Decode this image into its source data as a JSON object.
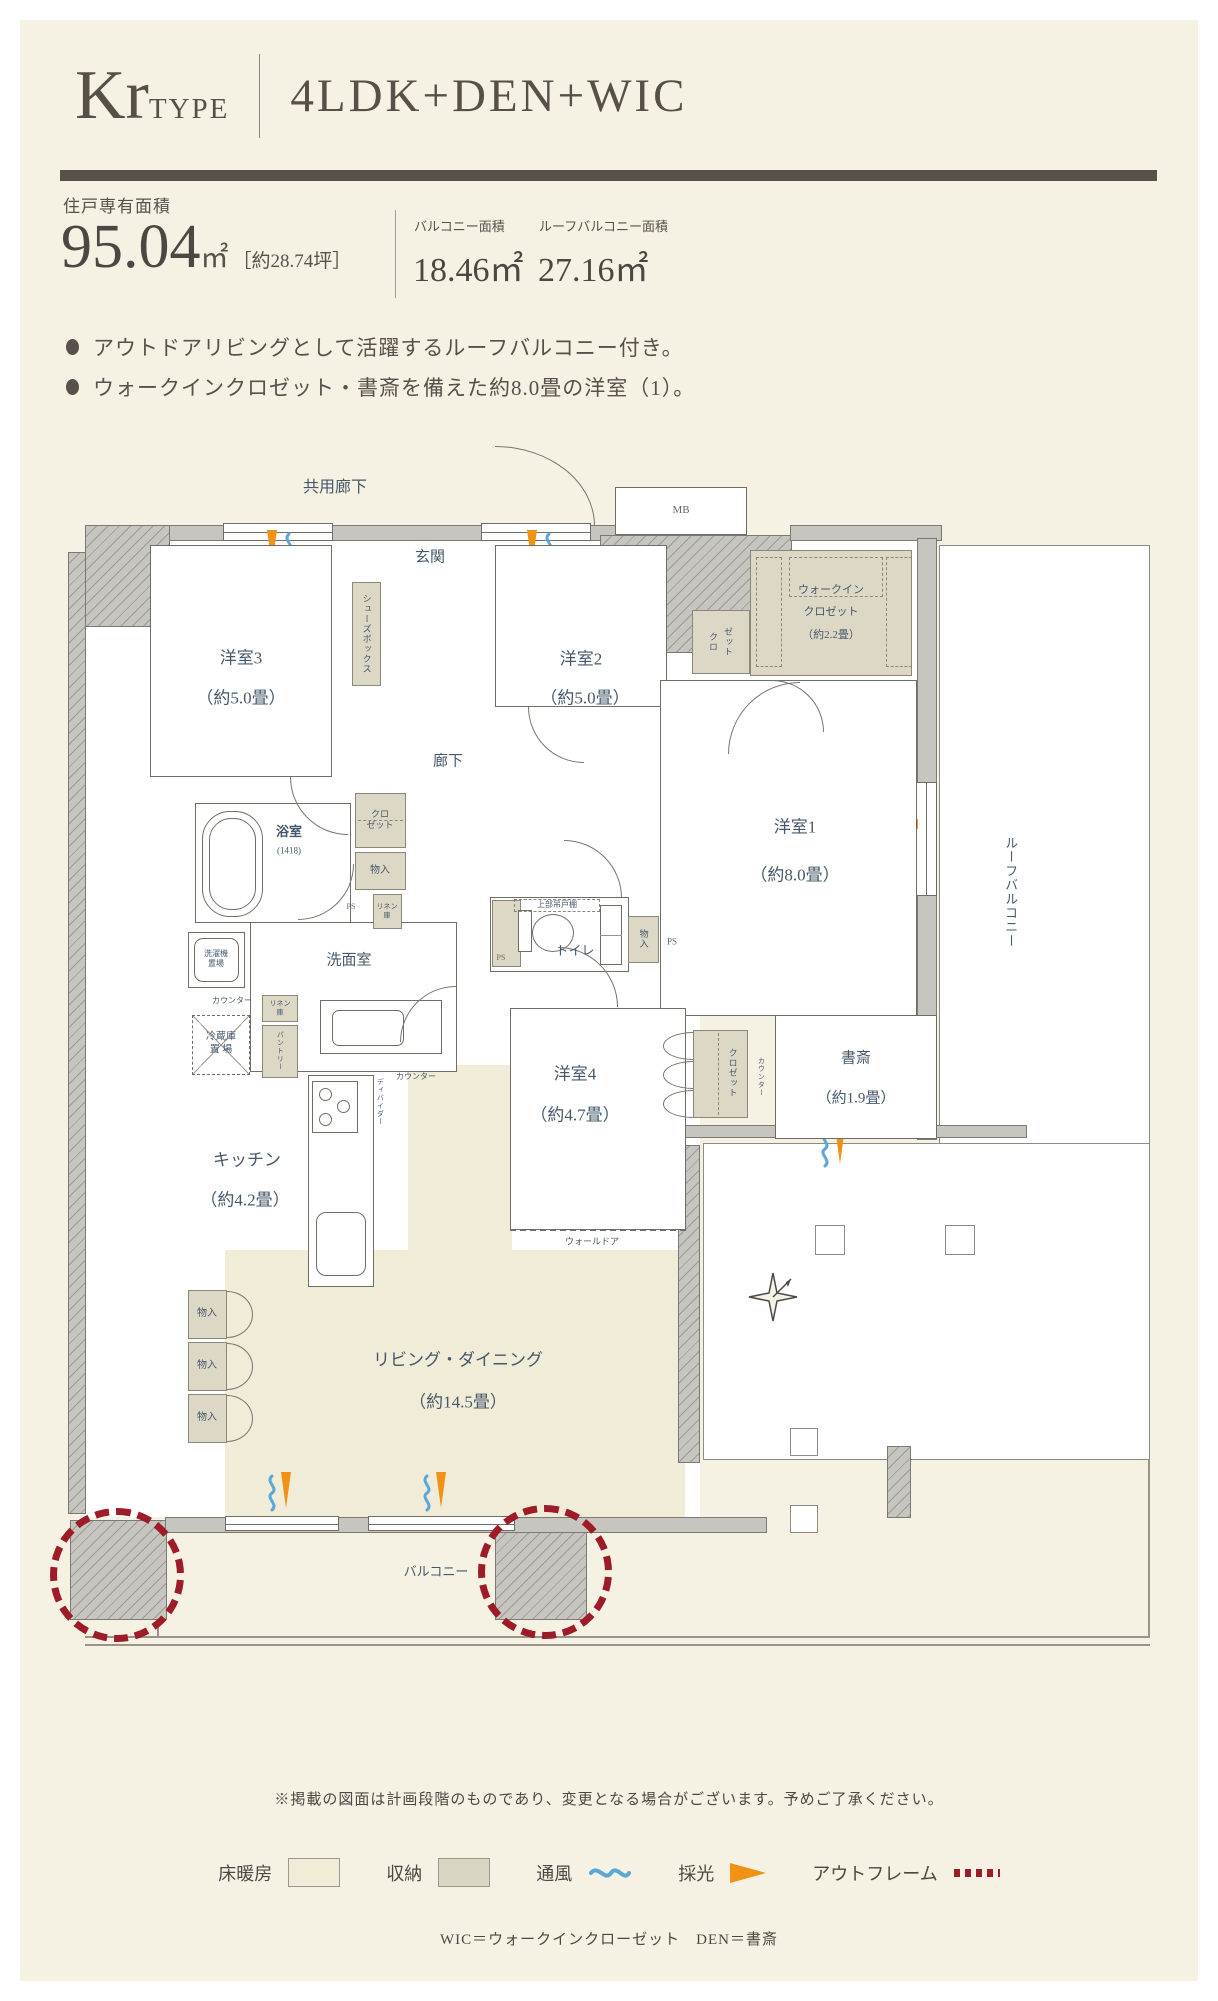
{
  "header": {
    "type_name": "Kr",
    "type_word": "TYPE",
    "layout": "4LDK+DEN+WIC"
  },
  "stats": {
    "exclusive_label": "住戸専有面積",
    "exclusive_value": "95.04",
    "exclusive_unit": "㎡",
    "exclusive_tsubo": "［約28.74坪］",
    "balcony_label": "バルコニー面積",
    "balcony_value": "18.46㎡",
    "roof_label": "ルーフバルコニー面積",
    "roof_value": "27.16㎡"
  },
  "features": {
    "f1": "アウトドアリビングとして活躍するルーフバルコニー付き。",
    "f2": "ウォークインクロゼット・書斎を備えた約8.0畳の洋室（1）。"
  },
  "plan": {
    "common_corridor": "共用廊下",
    "entrance": "玄関",
    "mb": "MB",
    "shoe_box": "シューズボックス",
    "w3_name": "洋室3",
    "w3_size": "（約5.0畳）",
    "w2_name": "洋室2",
    "w2_size": "（約5.0畳）",
    "w1_name": "洋室1",
    "w1_size": "（約8.0畳）",
    "w4_name": "洋室4",
    "w4_size": "（約4.7畳）",
    "wic1": "ウォークイン",
    "wic2": "クロゼット",
    "wic3": "（約2.2畳）",
    "closet": "クロゼット",
    "closet_l1": "クロ",
    "closet_l2": "ゼット",
    "corridor": "廊下",
    "bath_name": "浴室",
    "bath_size": "(1418)",
    "monoire": "物入",
    "ps": "PS",
    "linen_l1": "リネン",
    "linen_l2": "庫",
    "wash_name": "洗面室",
    "washer_l1": "洗濯機",
    "washer_l2": "置場",
    "counter": "カウンター",
    "pantry": "パントリー",
    "fridge_l1": "冷蔵庫",
    "fridge_l2": "置 場",
    "kitchen_name": "キッチン",
    "kitchen_size": "（約4.2畳）",
    "divider": "ディバイダー",
    "toilet": "トイレ",
    "upper_cabinet": "上部吊戸棚",
    "den_name": "書斎",
    "den_size": "（約1.9畳）",
    "wall_door": "ウォールドア",
    "ld_name": "リビング・ダイニング",
    "ld_size": "（約14.5畳）",
    "balcony": "バルコニー",
    "roof_balcony": "ルーフバルコニー"
  },
  "note": "※掲載の図面は計画段階のものであり、変更となる場合がございます。予めご了承ください。",
  "legend": {
    "floor_heating": "床暖房",
    "storage": "収納",
    "ventilation": "通風",
    "daylight": "採光",
    "outframe": "アウトフレーム"
  },
  "footnote": "WIC＝ウォークインクローゼット　DEN＝書斎",
  "colors": {
    "accent_orange": "#ef9215",
    "accent_blue": "#5aa7d8",
    "accent_red": "#9e1b28",
    "ink": "#57504b",
    "room_label": "#46586b"
  }
}
